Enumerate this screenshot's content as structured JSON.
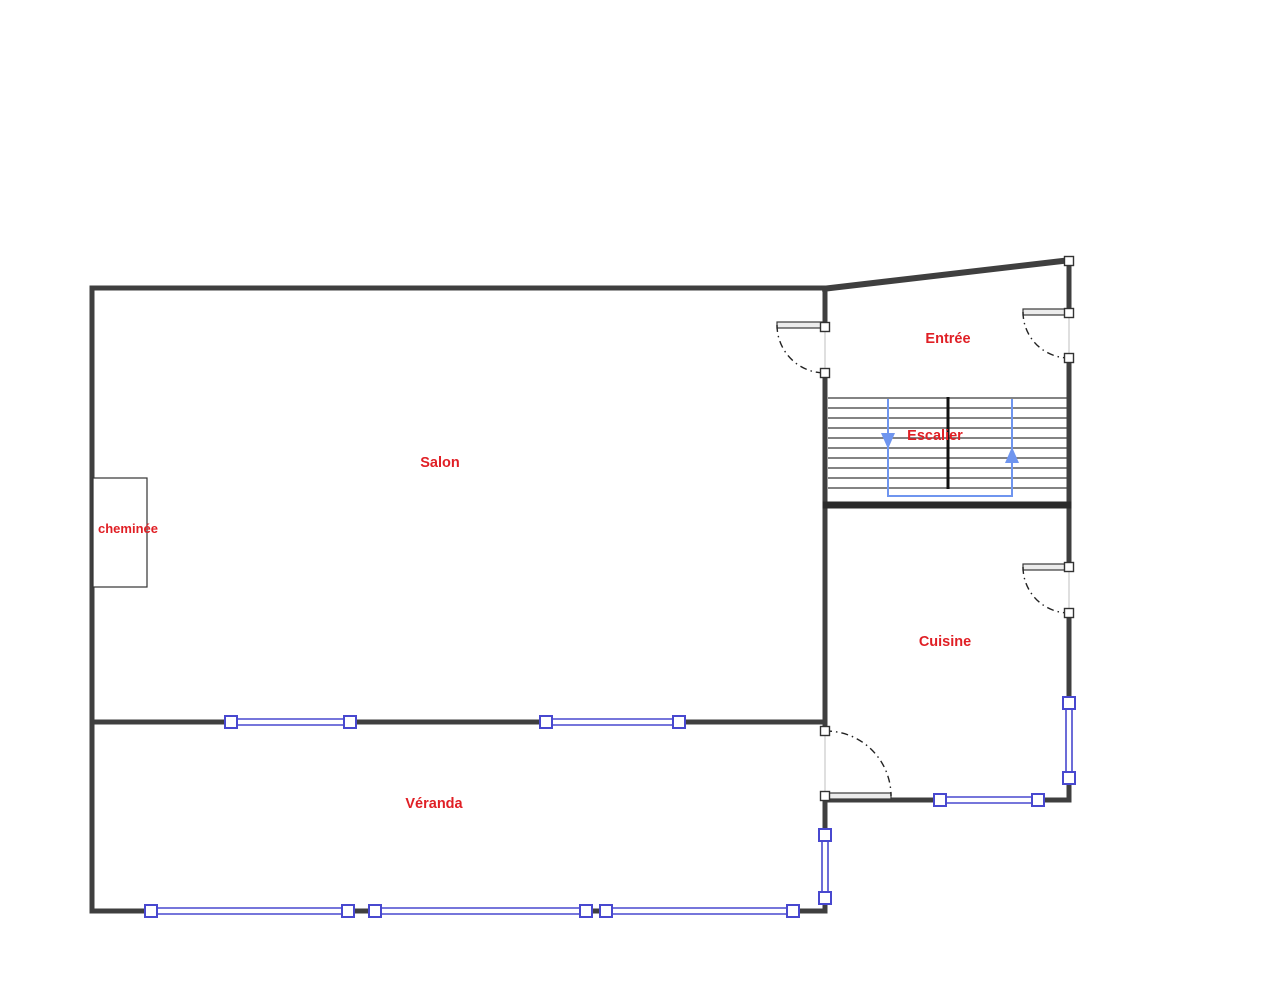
{
  "rooms": {
    "salon": {
      "label": "Salon"
    },
    "cheminee": {
      "label": "cheminée"
    },
    "entree": {
      "label": "Entrée"
    },
    "escalier": {
      "label": "Escalier"
    },
    "cuisine": {
      "label": "Cuisine"
    },
    "veranda": {
      "label": "Véranda"
    }
  },
  "colors": {
    "wall": "#3f3f3f",
    "wallHeavy": "#2b2b2b",
    "window": "#4848cf",
    "opening": "#c9c9c9",
    "doorArc": "#222222",
    "stairTread": "#5a5a5a",
    "stairDivider": "#111111",
    "stairPath": "#6f95ef",
    "label": "#e01f25",
    "background": "#ffffff"
  }
}
